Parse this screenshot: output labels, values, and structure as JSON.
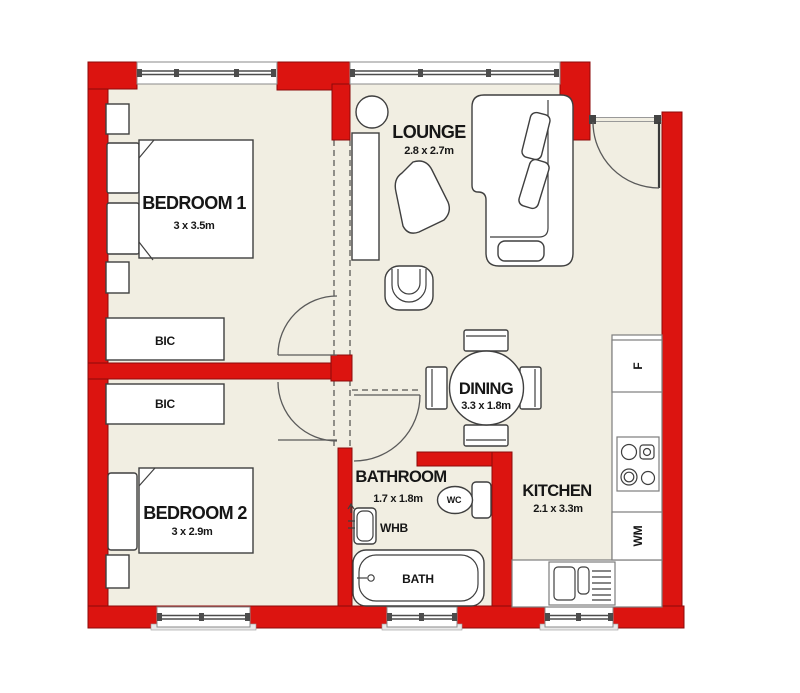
{
  "title": "Two bedroom apartment floor plan",
  "colors": {
    "wall": "#dc1410",
    "wall_edge": "#8c0a0a",
    "floor": "#f1eee2",
    "furniture_line": "#3f3f3f"
  },
  "rooms": {
    "bedroom1": {
      "name": "BEDROOM 1",
      "dims": "3 x 3.5m"
    },
    "bedroom2": {
      "name": "BEDROOM 2",
      "dims": "3 x 2.9m"
    },
    "lounge": {
      "name": "LOUNGE",
      "dims": "2.8 x 2.7m"
    },
    "dining": {
      "name": "DINING",
      "dims": "3.3 x 1.8m"
    },
    "kitchen": {
      "name": "KITCHEN",
      "dims": "2.1 x 3.3m"
    },
    "bathroom": {
      "name": "BATHROOM",
      "dims": "1.7 x 1.8m"
    }
  },
  "fixtures": {
    "bic1": "BIC",
    "bic2": "BIC",
    "wc": "WC",
    "whb": "WHB",
    "bath": "BATH",
    "fridge": "F",
    "washing_machine": "WM"
  }
}
